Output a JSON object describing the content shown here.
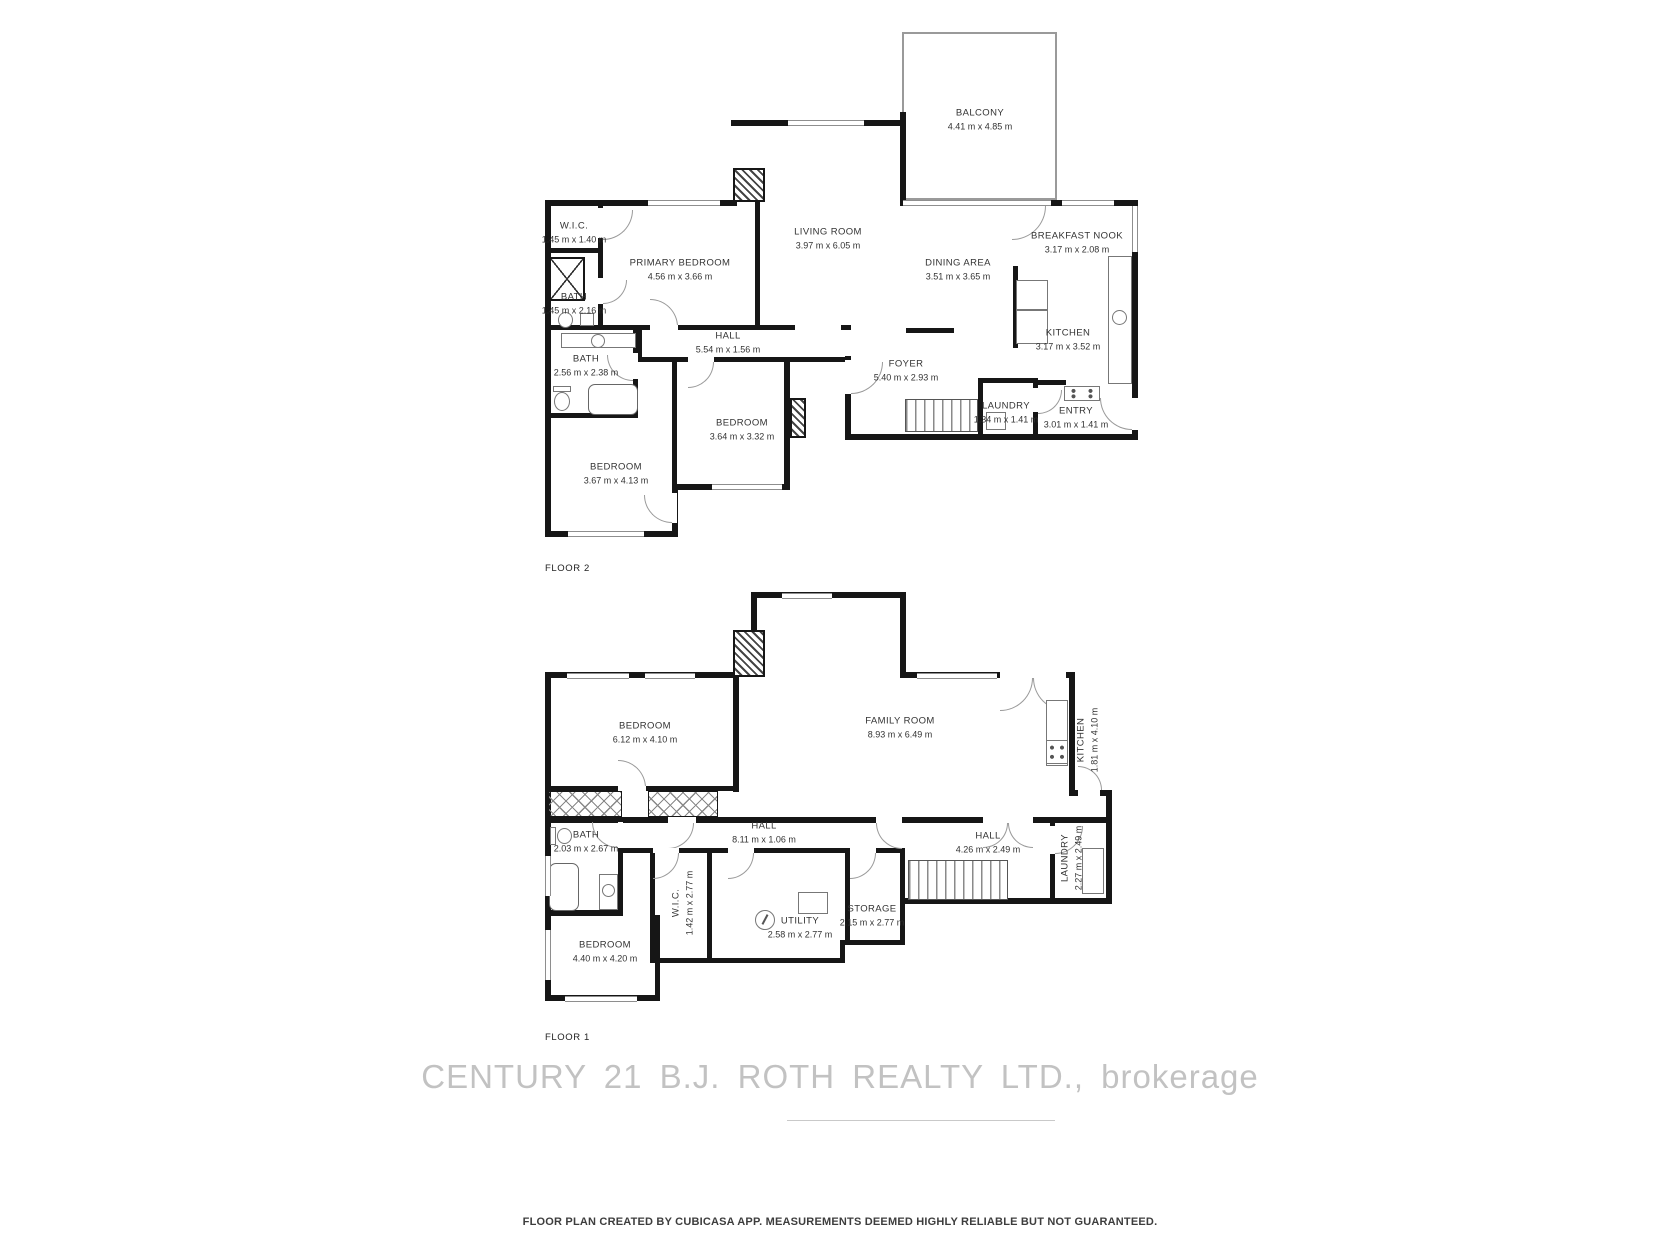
{
  "floor2": {
    "label": "FLOOR 2",
    "rooms": [
      {
        "name": "BALCONY",
        "dims": "4.41 m x 4.85 m"
      },
      {
        "name": "W.I.C.",
        "dims": "1.45 m x 1.40 m"
      },
      {
        "name": "PRIMARY BEDROOM",
        "dims": "4.56 m x 3.66 m"
      },
      {
        "name": "LIVING ROOM",
        "dims": "3.97 m x 6.05 m"
      },
      {
        "name": "DINING AREA",
        "dims": "3.51 m x 3.65 m"
      },
      {
        "name": "BREAKFAST NOOK",
        "dims": "3.17 m x 2.08 m"
      },
      {
        "name": "KITCHEN",
        "dims": "3.17 m x 3.52 m"
      },
      {
        "name": "BATH",
        "dims": "1.45 m x 2.16 m"
      },
      {
        "name": "HALL",
        "dims": "5.54 m x 1.56 m"
      },
      {
        "name": "BATH",
        "dims": "2.56 m x 2.38 m"
      },
      {
        "name": "FOYER",
        "dims": "5.40 m x 2.93 m"
      },
      {
        "name": "LAUNDRY",
        "dims": "1.34 m x 1.41 m"
      },
      {
        "name": "ENTRY",
        "dims": "3.01 m x 1.41 m"
      },
      {
        "name": "BEDROOM",
        "dims": "3.64 m x 3.32 m"
      },
      {
        "name": "BEDROOM",
        "dims": "3.67 m x 4.13 m"
      }
    ]
  },
  "floor1": {
    "label": "FLOOR 1",
    "rooms": [
      {
        "name": "BEDROOM",
        "dims": "6.12 m x 4.10 m"
      },
      {
        "name": "FAMILY ROOM",
        "dims": "8.93 m x 6.49 m"
      },
      {
        "name": "KITCHEN",
        "dims": "1.81 m x 4.10 m"
      },
      {
        "name": "BATH",
        "dims": "2.03 m x 2.67 m"
      },
      {
        "name": "HALL",
        "dims": "8.11 m x 1.06 m"
      },
      {
        "name": "HALL",
        "dims": "4.26 m x 2.49 m"
      },
      {
        "name": "LAUNDRY",
        "dims": "2.27 m x 2.49 m"
      },
      {
        "name": "W.I.C.",
        "dims": "1.42 m x 2.77 m"
      },
      {
        "name": "UTILITY",
        "dims": "2.58 m x 2.77 m"
      },
      {
        "name": "STORAGE",
        "dims": "2.15 m x 2.77 m"
      },
      {
        "name": "BEDROOM",
        "dims": "4.40 m x 4.20 m"
      }
    ]
  },
  "watermark": "CENTURY 21 B.J. ROTH REALTY LTD., brokerage",
  "footer": "FLOOR PLAN CREATED BY CUBICASA APP. MEASUREMENTS DEEMED HIGHLY RELIABLE BUT NOT GUARANTEED.",
  "colors": {
    "walls": "#161616",
    "labels": "#333333",
    "watermark": "#b3b3b3",
    "footer_text": "#3d3d3d"
  }
}
